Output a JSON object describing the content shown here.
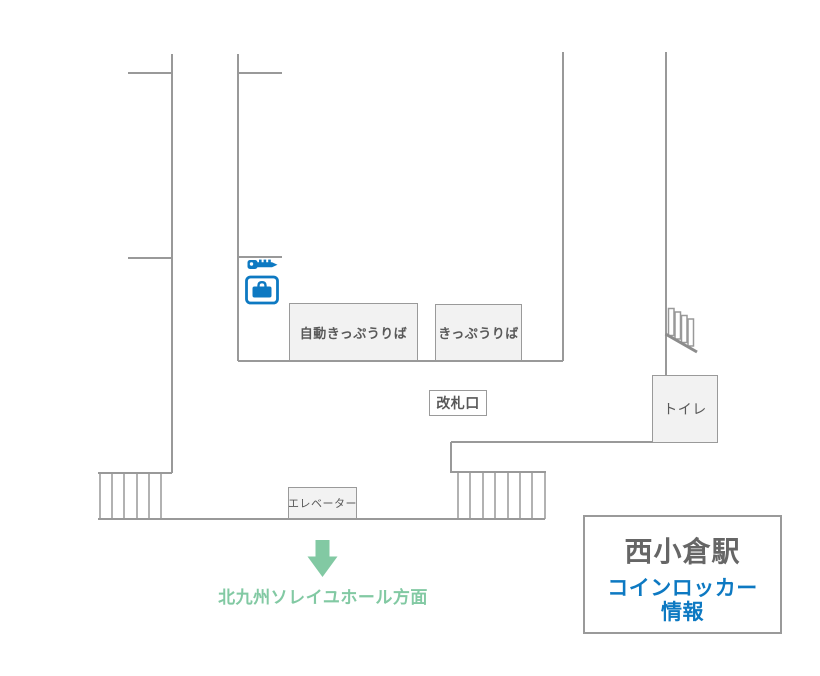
{
  "map": {
    "facilities": {
      "ticket_machines": "自動きっぷうりば",
      "ticket_office": "きっぷうりば",
      "ticket_gate": "改札口",
      "toilet": "トイレ",
      "elevator": "エレベーター"
    },
    "locker_marker": {
      "icons": [
        "key-icon",
        "coin-locker-icon"
      ]
    },
    "direction": {
      "icon": "down-arrow-icon",
      "label": "北九州ソレイユホール方面"
    },
    "legend": {
      "station_name": "西小倉駅",
      "info_line1": "コインロッカー",
      "info_line2": "情報"
    },
    "colors": {
      "accent_blue": "#0d79c2",
      "accent_green": "#82c9a3",
      "wall_gray": "#999999",
      "box_fill": "#f2f2f2",
      "box_border": "#9a9a9a",
      "text_gray": "#595959"
    }
  }
}
